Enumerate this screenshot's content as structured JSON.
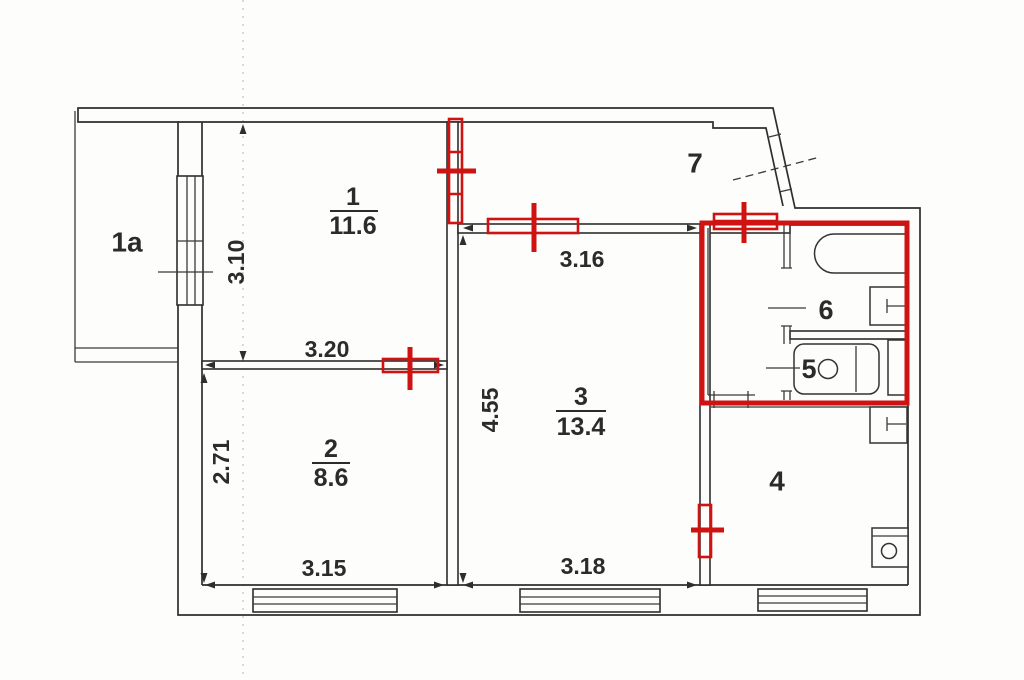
{
  "rooms": {
    "balcony": {
      "label": "1a"
    },
    "room1": {
      "number": "1",
      "area": "11.6"
    },
    "room2": {
      "number": "2",
      "area": "8.6"
    },
    "room3": {
      "number": "3",
      "area": "13.4"
    },
    "room4": {
      "label": "4"
    },
    "room5": {
      "label": "5"
    },
    "room6": {
      "label": "6"
    },
    "room7": {
      "label": "7"
    }
  },
  "dimensions": {
    "room1_depth": "3.10",
    "room1_width": "3.20",
    "room2_depth": "2.71",
    "room2_width": "3.15",
    "room3_width_top": "3.16",
    "room3_depth": "4.55",
    "room3_width_bottom": "3.18"
  },
  "colors": {
    "wall": "#2e2e2e",
    "renovation_markup": "#cf1212",
    "background": "#fdfdfb"
  },
  "icons": [
    "bathtub-icon",
    "washbasin-icon",
    "toilet-icon",
    "kitchen-sink-icon",
    "vent-duct-icon",
    "door-swing-icon",
    "window-icon"
  ]
}
